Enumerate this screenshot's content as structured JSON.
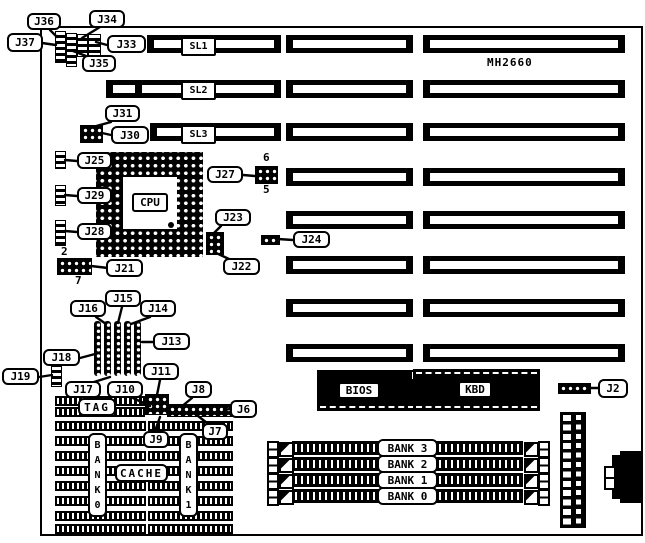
{
  "board": {
    "model": "MH2660"
  },
  "labels": {
    "J2": "J2",
    "J6": "J6",
    "J7": "J7",
    "J8": "J8",
    "J9": "J9",
    "J10": "J10",
    "J11": "J11",
    "J13": "J13",
    "J14": "J14",
    "J15": "J15",
    "J16": "J16",
    "J17": "J17",
    "J18": "J18",
    "J19": "J19",
    "J21": "J21",
    "J22": "J22",
    "J23": "J23",
    "J24": "J24",
    "J25": "J25",
    "J27": "J27",
    "J28": "J28",
    "J29": "J29",
    "J30": "J30",
    "J31": "J31",
    "J33": "J33",
    "J34": "J34",
    "J35": "J35",
    "J36": "J36",
    "J37": "J37"
  },
  "slots": {
    "sl1": "SL1",
    "sl2": "SL2",
    "sl3": "SL3"
  },
  "chips": {
    "cpu": "CPU",
    "tag": "TAG",
    "cache": "CACHE",
    "bios": "BIOS",
    "kbd": "KBD"
  },
  "cache_banks": {
    "bank0": "BANK0",
    "bank1": "BANK1"
  },
  "memory_banks": [
    "BANK 3",
    "BANK 2",
    "BANK 1",
    "BANK 0"
  ],
  "pin_numbers": {
    "j27_top": "6",
    "j27_bottom": "5",
    "j21_top": "2",
    "j21_bottom": "7"
  }
}
